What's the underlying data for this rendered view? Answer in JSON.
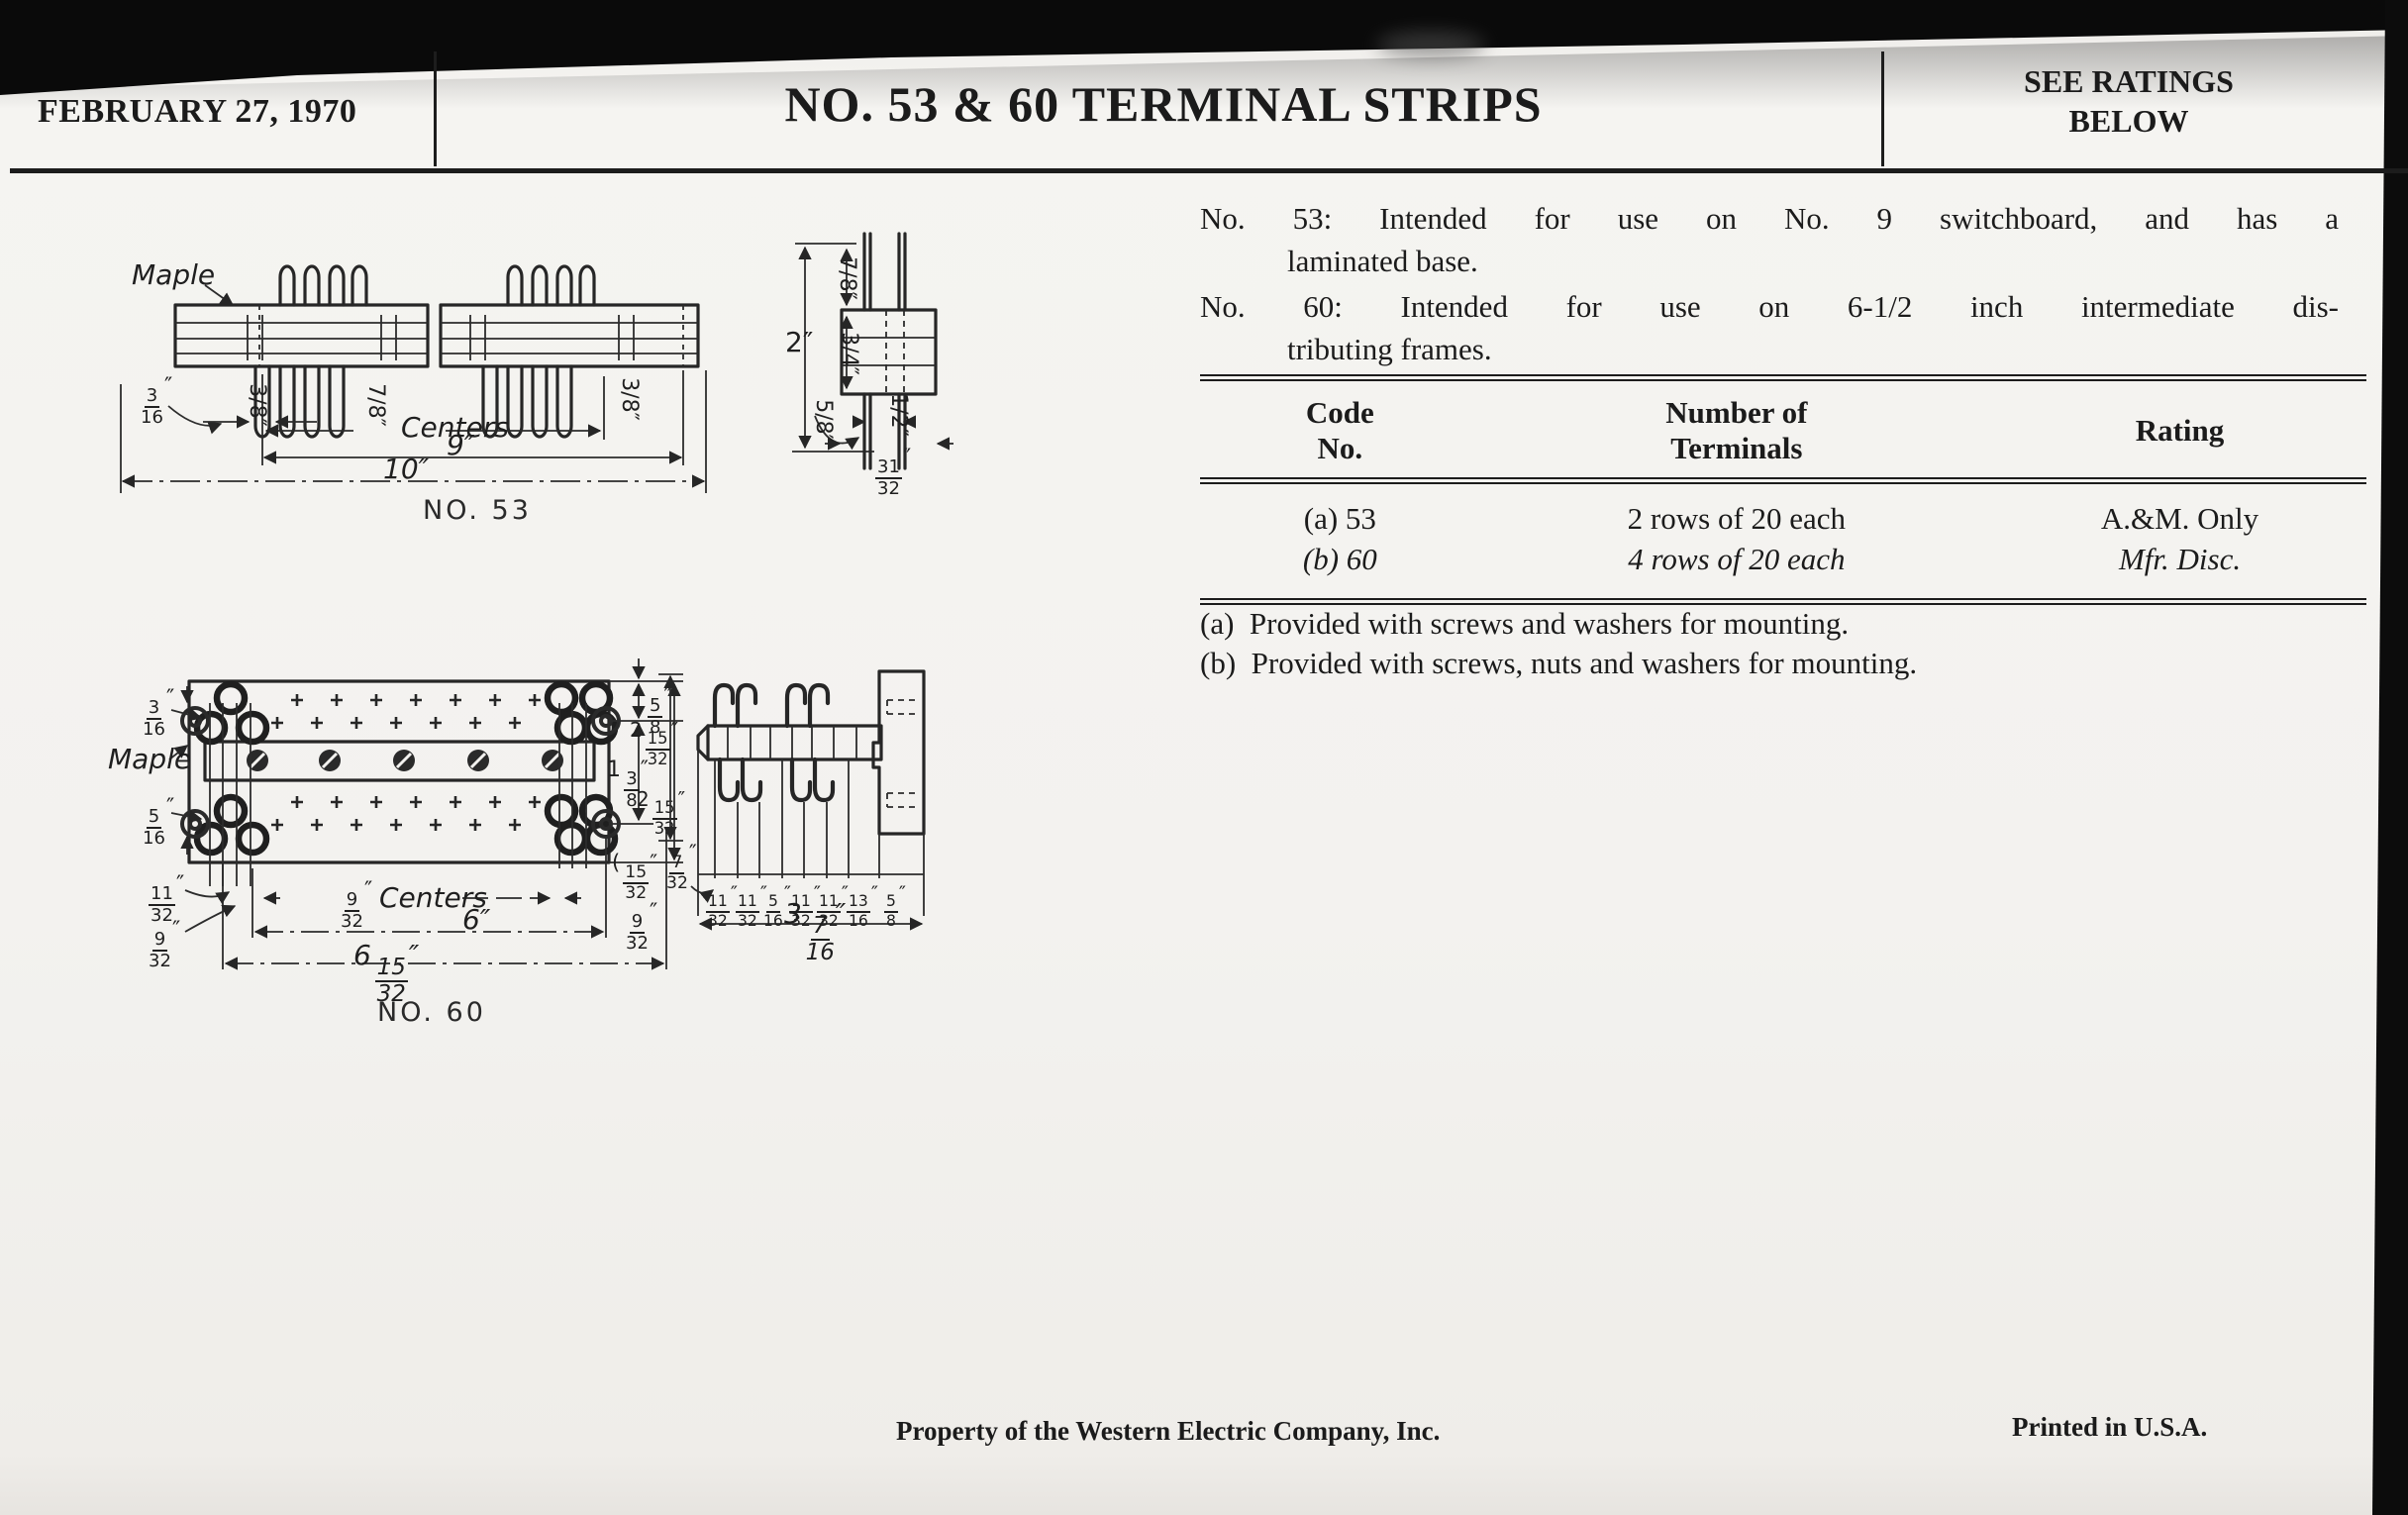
{
  "header": {
    "date": "FEBRUARY 27, 1970",
    "title": "NO. 53 & 60 TERMINAL STRIPS",
    "ratings_line1": "SEE RATINGS",
    "ratings_line2": "BELOW"
  },
  "intro": {
    "no53_line1": "No. 53:  Intended for use on No. 9 switchboard, and has a",
    "no53_line2": "laminated base.",
    "no60_line1": "No. 60:  Intended for use on 6-1/2 inch intermediate dis-",
    "no60_line2": "tributing frames."
  },
  "table": {
    "col1_header_line1": "Code",
    "col1_header_line2": "No.",
    "col2_header_line1": "Number of",
    "col2_header_line2": "Terminals",
    "col3_header": "Rating",
    "rows": [
      {
        "code": "(a) 53",
        "terminals": "2 rows of 20 each",
        "rating": "A.&M. Only"
      },
      {
        "code": "(b) 60",
        "terminals": "4 rows of 20 each",
        "rating": "Mfr. Disc."
      }
    ]
  },
  "notes": {
    "a": "(a)  Provided with screws and washers for mounting.",
    "b": "(b)  Provided with screws, nuts and washers for mounting."
  },
  "footer": {
    "property": "Property of the Western Electric Company, Inc.",
    "printed": "Printed in U.S.A."
  },
  "no53_plan": {
    "maple": {
      "text": "Maple"
    },
    "d316": {
      "n": "3",
      "d": "16",
      "suf": "″"
    },
    "dA": {
      "text": "3/8″"
    },
    "dB": {
      "text": "7/8″"
    },
    "centers": {
      "text": "Centers"
    },
    "dC": {
      "text": "3/8″"
    },
    "d9": {
      "text": "9″"
    },
    "d10": {
      "text": "10″"
    },
    "caption": {
      "text": "NO. 53"
    }
  },
  "no53_end": {
    "d2": {
      "text": "2″"
    },
    "dtop": {
      "text": "7/8″"
    },
    "dmid": {
      "text": "3/4″"
    },
    "d58": {
      "text": "5/8″"
    },
    "dhalf": {
      "text": "1/2″"
    },
    "d3132": {
      "n": "31",
      "d": "32",
      "suf": "″"
    }
  },
  "no60_plan": {
    "d316": {
      "n": "3",
      "d": "16",
      "suf": "″"
    },
    "maple": {
      "text": "Maple"
    },
    "d516": {
      "n": "5",
      "d": "16",
      "suf": "″"
    },
    "d58": {
      "n": "5",
      "d": "8",
      "suf": "″"
    },
    "d138": {
      "pre": "1",
      "n": "3",
      "d": "8",
      "suf": "″"
    },
    "d21532": {
      "pre": "2",
      "n": "15",
      "d": "32",
      "suf": "″"
    },
    "d1132": {
      "n": "11",
      "d": "32",
      "suf": "″"
    },
    "d932a": {
      "n": "9",
      "d": "32",
      "suf": "″"
    },
    "d932c": {
      "n": "9",
      "d": "32",
      "suf": "″"
    },
    "centers": {
      "text": "Centers"
    },
    "d6": {
      "text": "6″"
    },
    "d61532": {
      "pre": "6",
      "n": "15",
      "d": "32",
      "suf": "″"
    },
    "d932r": {
      "n": "9",
      "d": "32",
      "suf": "″"
    },
    "caption": {
      "text": "NO. 60"
    }
  },
  "no60_side": {
    "d21532": {
      "pre": "2",
      "n": "15",
      "d": "32",
      "suf": "″"
    },
    "d1532": {
      "pre": "(",
      "n": "15",
      "d": "32",
      "suf": "″"
    },
    "d732": {
      "n": "7",
      "d": "32",
      "suf": "″"
    },
    "chain": [
      {
        "n": "11",
        "d": "32",
        "suf": "″"
      },
      {
        "n": "11",
        "d": "32",
        "suf": "″"
      },
      {
        "n": "5",
        "d": "16",
        "suf": "″"
      },
      {
        "n": "11",
        "d": "32",
        "suf": "″"
      },
      {
        "n": "11",
        "d": "32",
        "suf": "″"
      },
      {
        "n": "13",
        "d": "16",
        "suf": "″"
      },
      {
        "n": "5",
        "d": "8",
        "suf": "″"
      }
    ],
    "d3716": {
      "pre": "3",
      "n": "7",
      "d": "16",
      "suf": "″"
    }
  }
}
